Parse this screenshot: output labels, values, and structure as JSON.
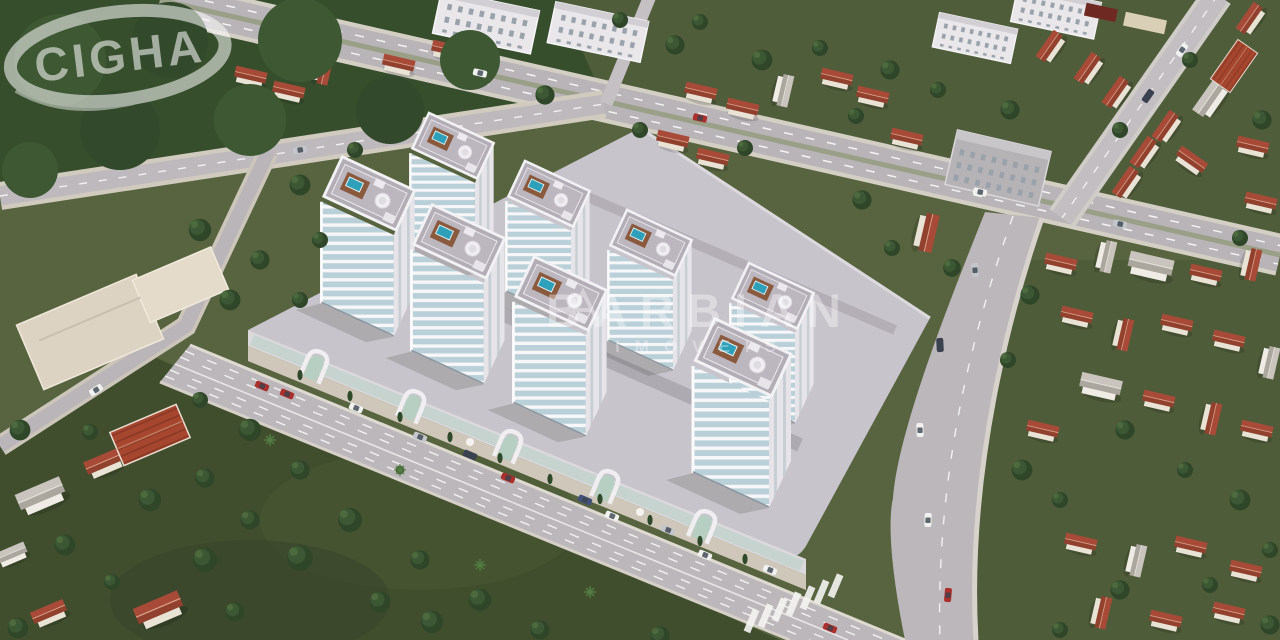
{
  "branding": {
    "logo_text": "CIGHA",
    "watermark_text": "BARBIAN",
    "watermark_subtext": "IMÓVEIS"
  },
  "scene": {
    "tower_count": 8,
    "subject": "aerial render of residential tower complex in suburban neighborhood"
  },
  "colors": {
    "grass": "#57643f",
    "grass_dark": "#414e2e",
    "forest": "#374e2d",
    "road": "#bcb7ba",
    "road_major": "#b8b4b7",
    "sidewalk": "#cfc8ba",
    "podium": "#c8c4cb",
    "tower_wall": "#f7f6f8",
    "tower_glass": "#b9d0d8",
    "tower_roof": "#b3adb6",
    "roof_red": "#a84a38",
    "roof_gray": "#c9c5be",
    "house_wall": "#e9e3d6",
    "deck_wood": "#8a5a3f",
    "pool": "#2fa0ba",
    "wall_glass": "#b9cfc6",
    "watermark_ink": "#ffffff"
  }
}
